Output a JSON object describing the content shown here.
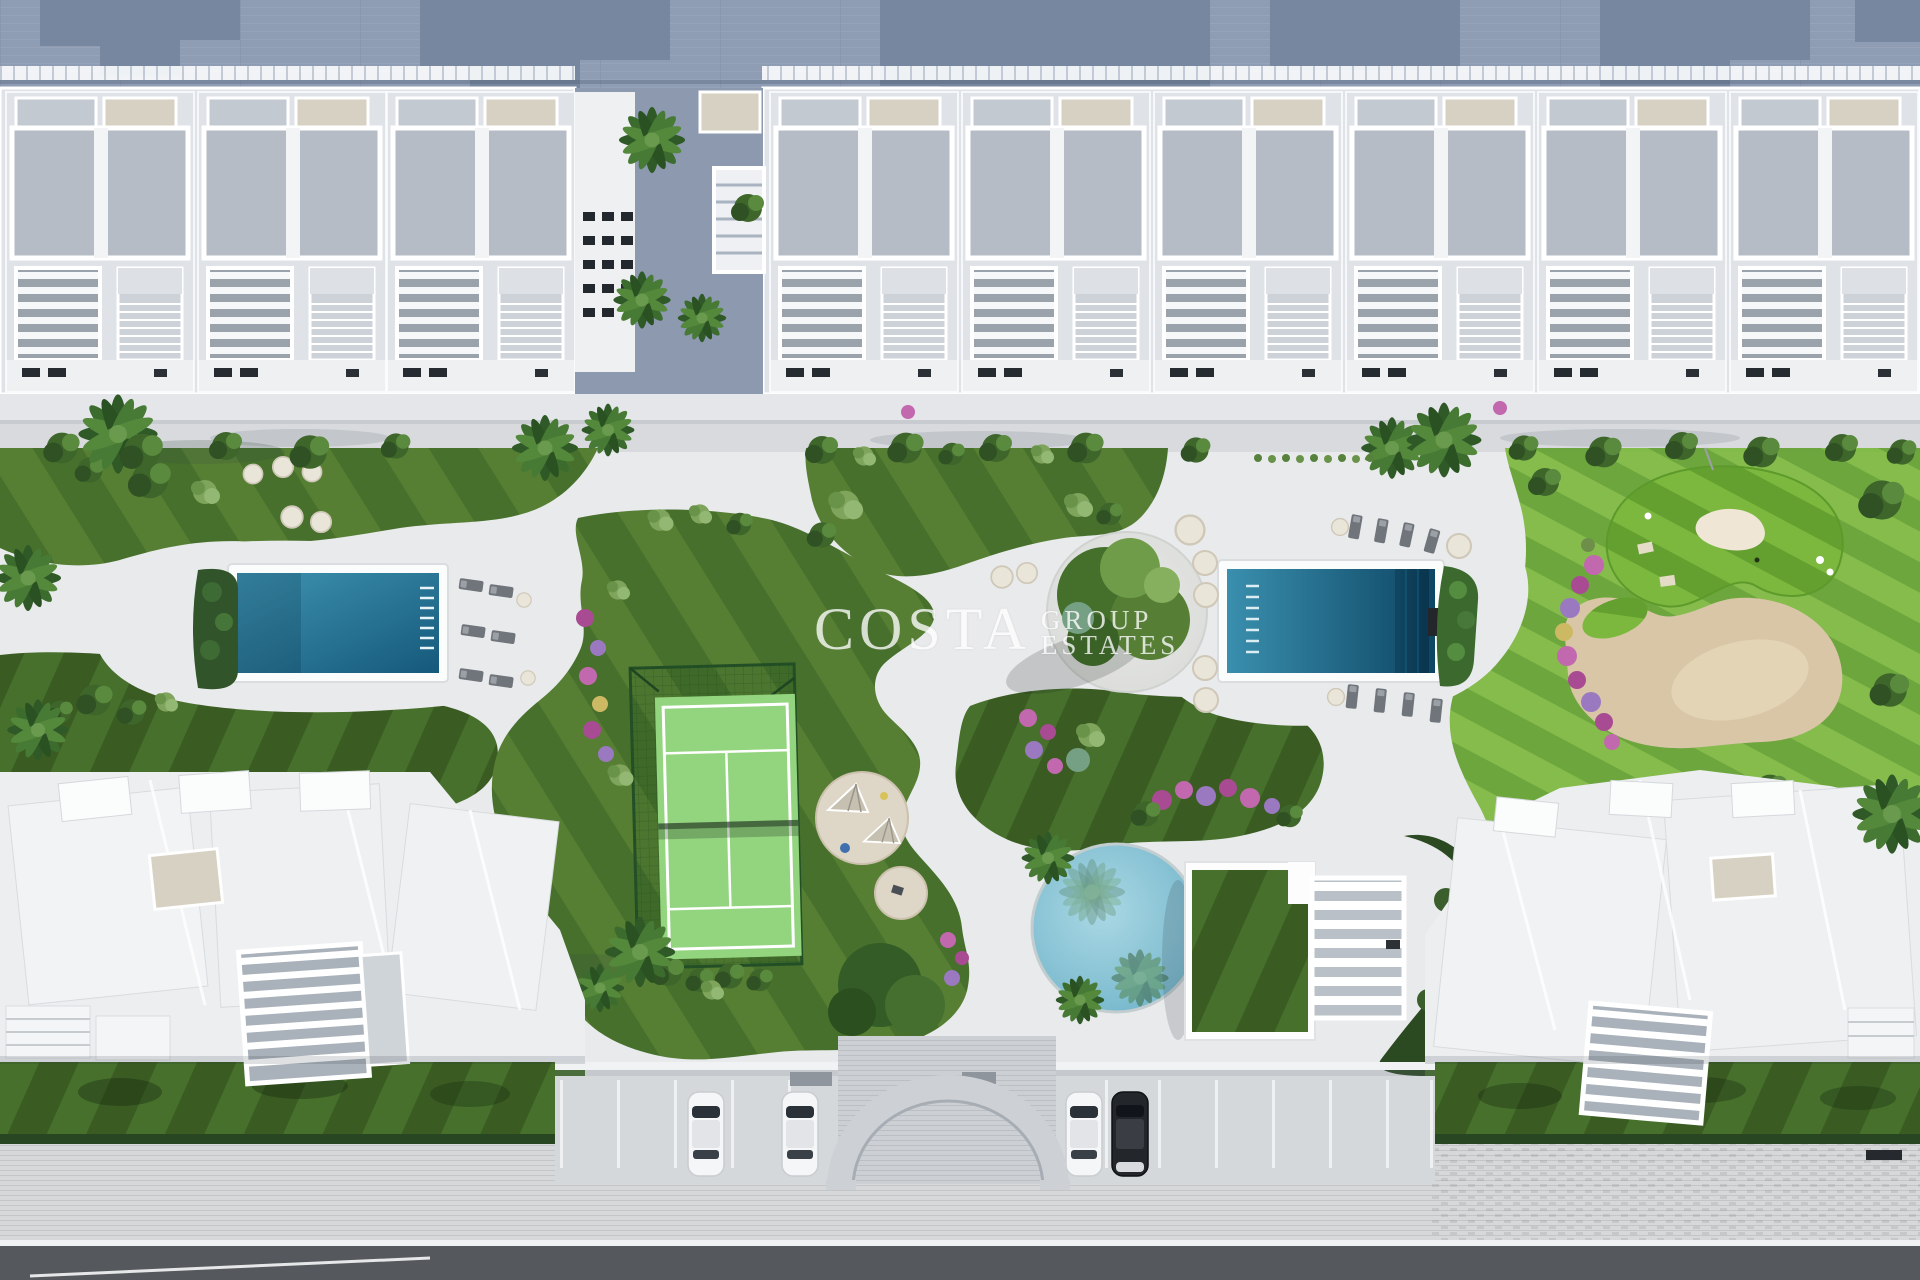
{
  "watermark": {
    "brand": "COSTA",
    "line1": "GROUP",
    "line2": "ESTATES"
  },
  "palette": {
    "watermark_color": "#ffffff",
    "warehouse_roof": "#8f9db4",
    "warehouse_shadow": "#76879f",
    "block_base": "#dfe3e8",
    "roof_deck": "#b5bcc5",
    "building_white": "#f2f4f5",
    "beige": "#d7d1c3",
    "courtyard": "#8c99af",
    "walkway": "#d8dadd",
    "paving": "#e9eaec",
    "lawn_dark": "#46702b",
    "lawn_light": "#567f33",
    "lawn_deep": "#3a5c22",
    "golf_light": "#7cb83e",
    "golf_dark": "#63a02f",
    "hedge_dark": "#2c4a22",
    "sand": "#d8c6a7",
    "sand_light": "#e6d7ba",
    "pool_light": "#3f93b2",
    "pool_deep": "#15597b",
    "round_pool": "#8ec8da",
    "court_green": "#93d47f",
    "cage_green": "#234f26",
    "sidewalk": "#d7d8d9",
    "parking": "#d5d8db",
    "road": "#55585c",
    "car_white": "#f5f6f7",
    "car_dark": "#23262b",
    "flower_pink": "#c268ae",
    "flower_magenta": "#a84b92",
    "flower_violet": "#9a79c0",
    "flower_yellow": "#cdb964"
  }
}
